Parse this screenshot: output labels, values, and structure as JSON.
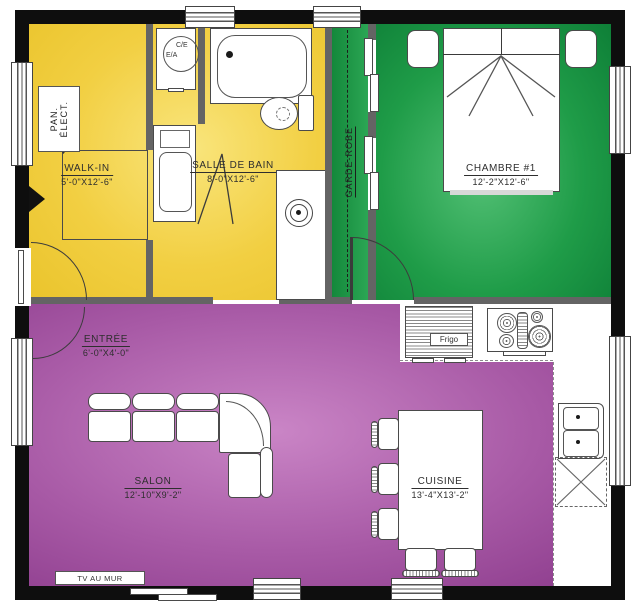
{
  "rooms": {
    "walk_in": {
      "name": "WALK-IN",
      "dims": "5'-0\"X12'-6\""
    },
    "salle_de_bain": {
      "name": "SALLE DE BAIN",
      "dims": "8'-0\"X12'-6\""
    },
    "chambre": {
      "name": "CHAMBRE #1",
      "dims": "12'-2\"X12'-6\""
    },
    "entree": {
      "name": "ENTRÉE",
      "dims": "6'-0\"X4'-0\""
    },
    "salon": {
      "name": "SALON",
      "dims": "12'-10\"X9'-2\""
    },
    "cuisine": {
      "name": "CUISINE",
      "dims": "13'-4\"X13'-2\""
    },
    "garde_robe": {
      "name": "GARDE-ROBE"
    }
  },
  "annotations": {
    "electrical_panel_line1": "PAN.",
    "electrical_panel_line2": "ÉLECT.",
    "water_heater_top": "C/E",
    "water_heater_bottom": "E/A",
    "fridge": "Frigo",
    "tv": "TV AU MUR"
  },
  "colors": {
    "exterior_wall": "#0e0e0e",
    "partition_wall": "#646464",
    "service_zone_yellow": "#f2cf42",
    "bedroom_zone_green": "#1f9c48",
    "living_zone_purple": "#a85aa6"
  }
}
